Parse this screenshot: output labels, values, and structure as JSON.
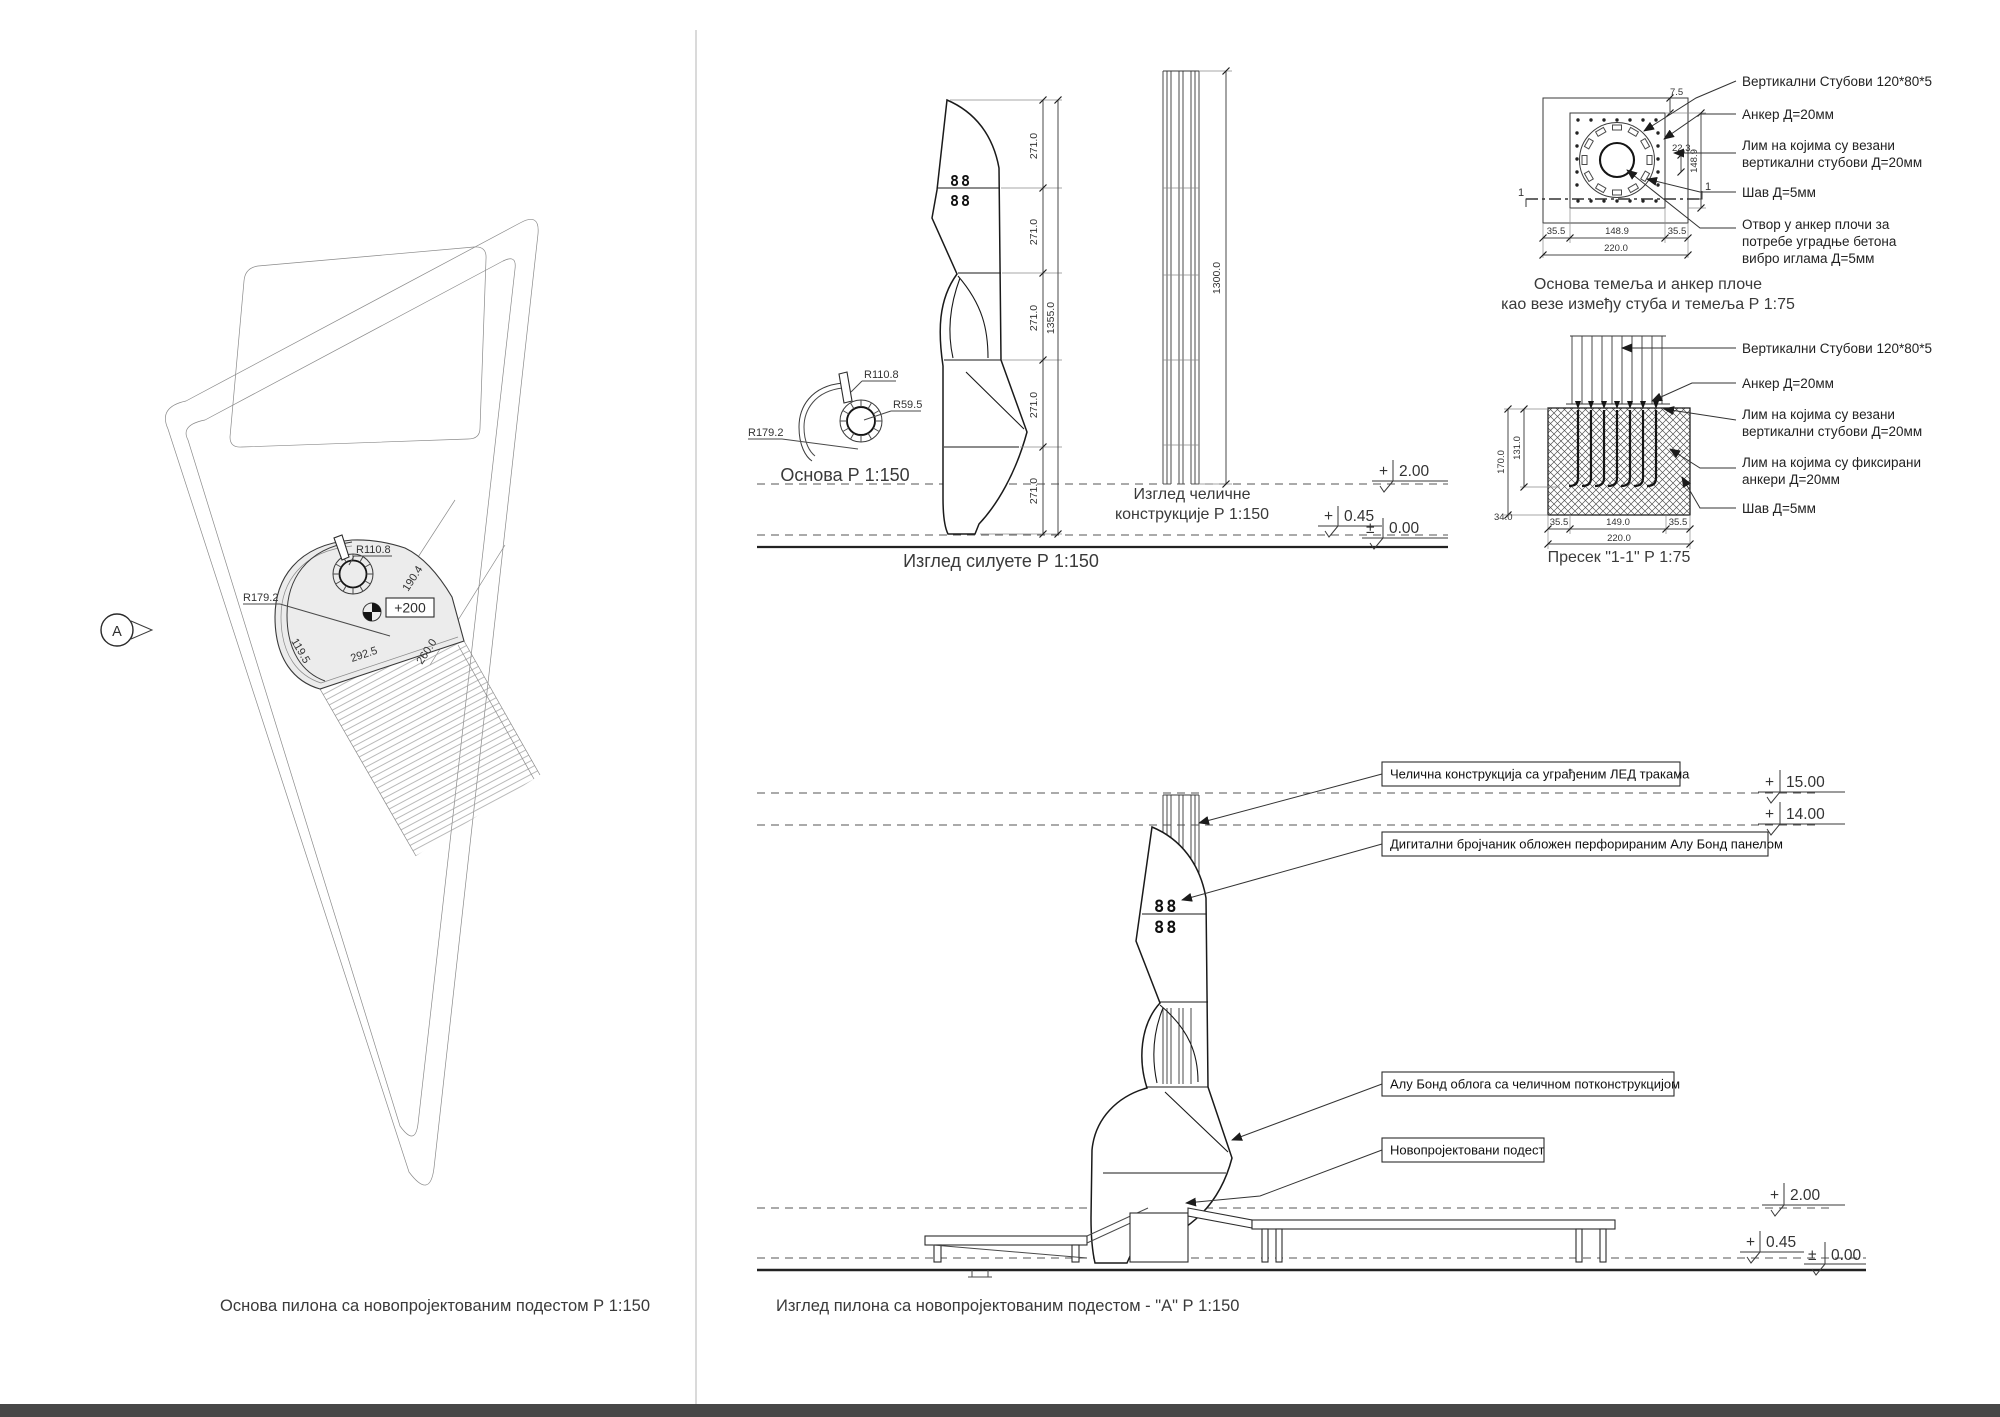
{
  "site_plan": {
    "caption": "Основа пилона  са новопројектованим подестом  Р 1:150",
    "view_marker": "А",
    "spot_level": "+200",
    "r_inner": "R110.8",
    "r_outer": "R179.2",
    "dim_edge": "292.5",
    "dim_sw": "119.5",
    "dim_ne": "190.4",
    "dim_se": "260.0"
  },
  "silhouette": {
    "caption": "Изглед силуете Р 1:150",
    "seg": [
      "271.0",
      "271.0",
      "271.0",
      "271.0",
      "271.0"
    ],
    "total": "1355.0",
    "clock_row": "88"
  },
  "base_detail": {
    "caption": "Основа Р 1:150",
    "r1": "R110.8",
    "r2": "R59.5",
    "r3": "R179.2"
  },
  "steel": {
    "cap1": "Изглед челичне",
    "cap2": "конструкције Р 1:150",
    "dim": "1300.0"
  },
  "levels": {
    "plus": "+",
    "pm": "±",
    "v15": "15.00",
    "v14": "14.00",
    "v2": "2.00",
    "v045": "0.45",
    "v0": "0.00"
  },
  "plate": {
    "cap1": "Основа темеља и анкер плоче",
    "cap2": "као везе између стуба и темеља Р 1:75",
    "mark": "1",
    "d75": "7.5",
    "d223": "22.3",
    "d1489v": "148.9",
    "b1": "35.5",
    "b2": "148.9",
    "b3": "35.5",
    "btot": "220.0",
    "callouts": [
      {
        "l1": "Вертикални Стубови 120*80*5"
      },
      {
        "l1": "Анкер Д=20мм"
      },
      {
        "l1": "Лим на којима су везани",
        "l2": "вертикални стубови Д=20мм"
      },
      {
        "l1": "Шав Д=5мм"
      },
      {
        "l1": "Отвор у анкер плочи за",
        "l2": "потребе уградње бетона",
        "l3": "вибро иглама Д=5мм"
      }
    ]
  },
  "section": {
    "caption": "Пресек \"1-1\" Р 1:75",
    "v170": "170.0",
    "v131": "131.0",
    "v34": "34.0",
    "b1": "35.5",
    "b2": "149.0",
    "b3": "35.5",
    "btot": "220.0",
    "callouts": [
      {
        "l1": "Вертикални Стубови 120*80*5"
      },
      {
        "l1": "Анкер Д=20мм"
      },
      {
        "l1": "Лим на којима су везани",
        "l2": "вертикални стубови Д=20мм"
      },
      {
        "l1": "Лим на којима су фиксирани",
        "l2": "анкери Д=20мм"
      },
      {
        "l1": "Шав Д=5мм"
      }
    ]
  },
  "elevation": {
    "caption": "Изглед пилона  са новопројектованим подестом - \"А\" Р 1:150",
    "clock_row": "88",
    "callouts": [
      "Челична конструкција са уграђеним ЛЕД тракама",
      "Дигитални бројчаник обложен перфорираним Алу Бонд панелом",
      "Алу Бонд облога са челичном потконструкцијом",
      "Новопројектовани подест"
    ]
  }
}
